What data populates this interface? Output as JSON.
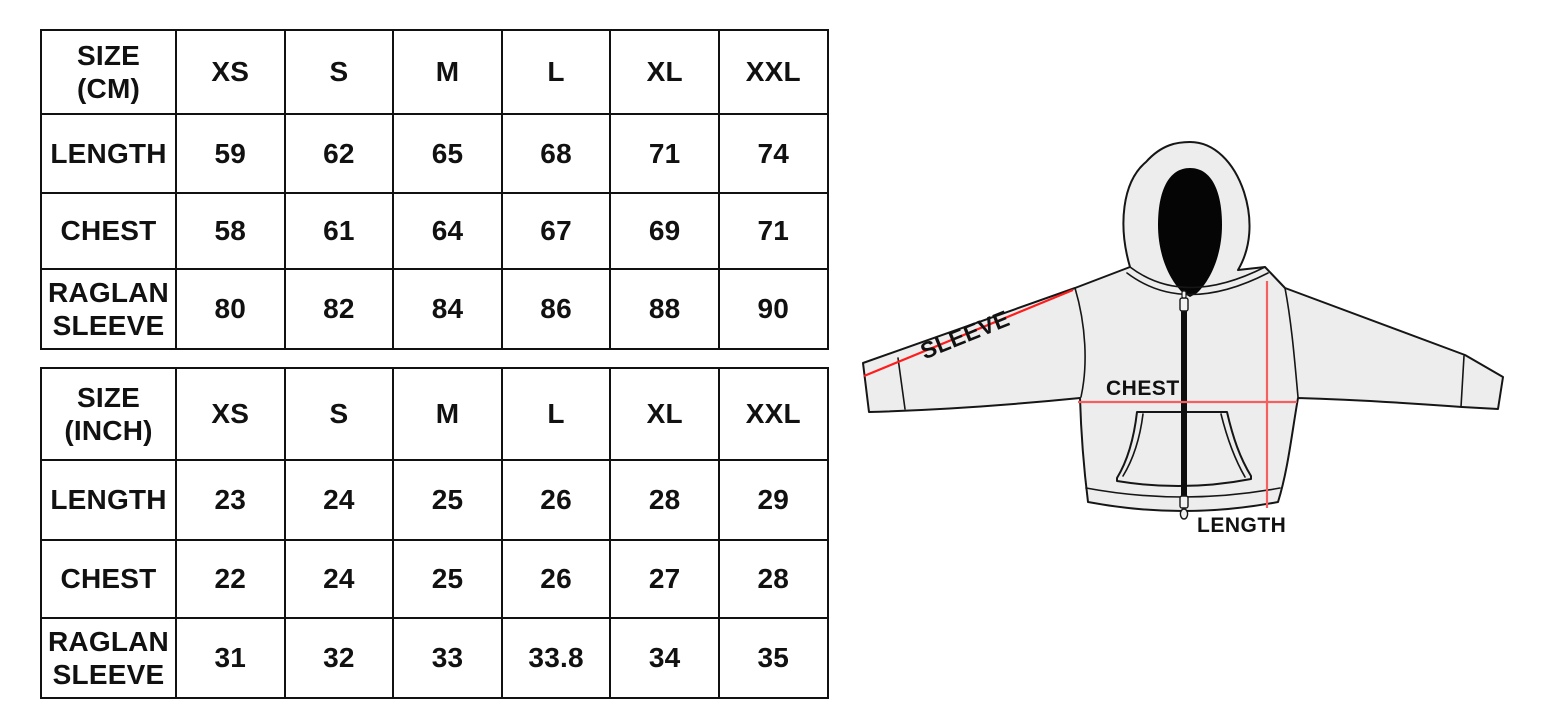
{
  "page": {
    "background_color": "#ffffff",
    "description_labels": {
      "sleeve": "SLEEVE",
      "chest": "CHEST",
      "length": "LENGTH"
    }
  },
  "chart_data": [
    {
      "type": "table",
      "title": "SIZE (CM)",
      "title_lines": {
        "line1": "SIZE",
        "line2": "(CM)"
      },
      "columns": [
        "XS",
        "S",
        "M",
        "L",
        "XL",
        "XXL"
      ],
      "rows": [
        {
          "label": "LENGTH",
          "label_line1": "LENGTH",
          "label_line2": "",
          "values": [
            "59",
            "62",
            "65",
            "68",
            "71",
            "74"
          ]
        },
        {
          "label": "CHEST",
          "label_line1": "CHEST",
          "label_line2": "",
          "values": [
            "58",
            "61",
            "64",
            "67",
            "69",
            "71"
          ]
        },
        {
          "label": "RAGLAN SLEEVE",
          "label_line1": "RAGLAN",
          "label_line2": "SLEEVE",
          "values": [
            "80",
            "82",
            "84",
            "86",
            "88",
            "90"
          ]
        }
      ]
    },
    {
      "type": "table",
      "title": "SIZE (INCH)",
      "title_lines": {
        "line1": "SIZE",
        "line2": "(INCH)"
      },
      "columns": [
        "XS",
        "S",
        "M",
        "L",
        "XL",
        "XXL"
      ],
      "rows": [
        {
          "label": "LENGTH",
          "label_line1": "LENGTH",
          "label_line2": "",
          "values": [
            "23",
            "24",
            "25",
            "26",
            "28",
            "29"
          ]
        },
        {
          "label": "CHEST",
          "label_line1": "CHEST",
          "label_line2": "",
          "values": [
            "22",
            "24",
            "25",
            "26",
            "27",
            "28"
          ]
        },
        {
          "label": "RAGLAN SLEEVE",
          "label_line1": "RAGLAN",
          "label_line2": "SLEEVE",
          "values": [
            "31",
            "32",
            "33",
            "33.8",
            "34",
            "35"
          ]
        }
      ]
    }
  ],
  "hoodie": {
    "labels": {
      "sleeve": "SLEEVE",
      "chest": "CHEST",
      "length": "LENGTH"
    },
    "colors": {
      "fabric": "#ededed",
      "fabric_mottle": "#d9d9d9",
      "outline": "#161616",
      "hood_interior": "#050505",
      "zipper": "#0d0d0d",
      "sleeve_line": "#ff1c1c",
      "chest_line": "#f65f5f",
      "length_line": "#f65f5f"
    }
  }
}
